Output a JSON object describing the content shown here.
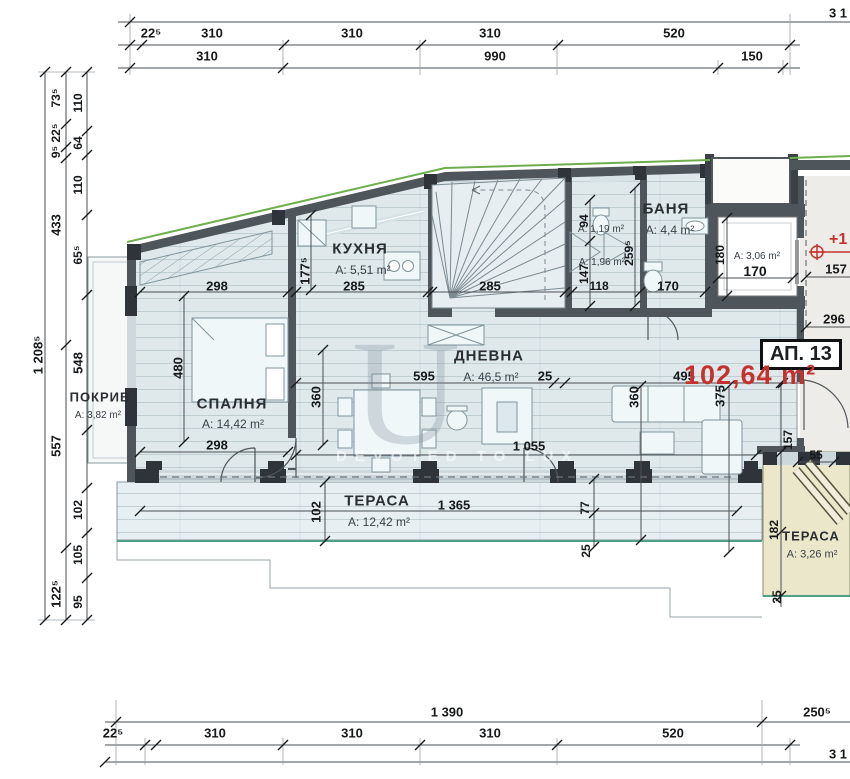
{
  "colors": {
    "red": "#c5322d",
    "green_top": "#6fae4e",
    "green_edge": "#4f9f86",
    "wall": "#4e555b",
    "pier": "#2e3439",
    "floor": "#dfe9ec",
    "terrace_beige": "#ebe7cb"
  },
  "apartment": {
    "id_label": "АП. 13",
    "area_label": "102,64 m²",
    "level_mark": "+1"
  },
  "watermark": {
    "letter": "U",
    "tagline": "DEVOTED TO LUX"
  },
  "rooms": [
    {
      "name": "ПОКРИВ",
      "area": "A: 3,82 m²",
      "nx": 100,
      "ny": 397,
      "ax": 98,
      "ay": 416,
      "ns": 13,
      "as": 10
    },
    {
      "name": "СПАЛНЯ",
      "area": "A: 14,42 m²",
      "nx": 232,
      "ny": 404,
      "ax": 233,
      "ay": 424,
      "ns": 15,
      "as": 12
    },
    {
      "name": "КУХНЯ",
      "area": "A: 5,51 m²",
      "nx": 360,
      "ny": 249,
      "ax": 363,
      "ay": 270,
      "ns": 15,
      "as": 12
    },
    {
      "name": "ДНЕВНА",
      "area": "A: 46,5 m²",
      "nx": 489,
      "ny": 356,
      "ax": 491,
      "ay": 377,
      "ns": 15,
      "as": 12
    },
    {
      "name": "БАНЯ",
      "area": "A: 4,4 m²",
      "nx": 666,
      "ny": 209,
      "ax": 670,
      "ay": 230,
      "ns": 15,
      "as": 12
    },
    {
      "name": "ТЕРАСА",
      "area": "A: 12,42 m²",
      "nx": 377,
      "ny": 501,
      "ax": 379,
      "ay": 522,
      "ns": 15,
      "as": 12
    },
    {
      "name": "ТЕРАСА",
      "area": "A: 3,26 m²",
      "nx": 811,
      "ny": 536,
      "ax": 812,
      "ay": 555,
      "ns": 13,
      "as": 11
    },
    {
      "name": "",
      "area": "A: 1,19 m²",
      "ax": 601,
      "ay": 230,
      "as": 10
    },
    {
      "name": "",
      "area": "A: 1,96 m²",
      "ax": 602,
      "ay": 263,
      "as": 10
    },
    {
      "name": "",
      "area": "A: 3,06 m²",
      "ax": 757,
      "ay": 257,
      "as": 10
    }
  ],
  "dims": [
    {
      "t": "3 1",
      "x": 838,
      "y": 13
    },
    {
      "t": "22⁵",
      "x": 151,
      "y": 33
    },
    {
      "t": "310",
      "x": 212,
      "y": 33
    },
    {
      "t": "310",
      "x": 352,
      "y": 33
    },
    {
      "t": "310",
      "x": 490,
      "y": 33
    },
    {
      "t": "520",
      "x": 674,
      "y": 33
    },
    {
      "t": "310",
      "x": 207,
      "y": 56
    },
    {
      "t": "990",
      "x": 495,
      "y": 56
    },
    {
      "t": "150",
      "x": 752,
      "y": 56
    },
    {
      "t": "1 390",
      "x": 447,
      "y": 712
    },
    {
      "t": "250⁵",
      "x": 817,
      "y": 712
    },
    {
      "t": "22⁵",
      "x": 113,
      "y": 733
    },
    {
      "t": "310",
      "x": 215,
      "y": 733
    },
    {
      "t": "310",
      "x": 352,
      "y": 733
    },
    {
      "t": "310",
      "x": 490,
      "y": 733
    },
    {
      "t": "520",
      "x": 673,
      "y": 733
    },
    {
      "t": "3 1",
      "x": 838,
      "y": 754
    },
    {
      "t": "1 208⁵",
      "x": 38,
      "y": 355,
      "o": "v"
    },
    {
      "t": "73⁵",
      "x": 56,
      "y": 98,
      "o": "v",
      "s": 12
    },
    {
      "t": "22⁵",
      "x": 56,
      "y": 133,
      "o": "v",
      "s": 12
    },
    {
      "t": "9⁵",
      "x": 56,
      "y": 152,
      "o": "v",
      "s": 12
    },
    {
      "t": "433",
      "x": 56,
      "y": 225,
      "o": "v"
    },
    {
      "t": "557",
      "x": 56,
      "y": 446,
      "o": "v"
    },
    {
      "t": "122⁵",
      "x": 56,
      "y": 594,
      "o": "v"
    },
    {
      "t": "110",
      "x": 78,
      "y": 103,
      "o": "v",
      "s": 12
    },
    {
      "t": "64",
      "x": 78,
      "y": 143,
      "o": "v",
      "s": 12
    },
    {
      "t": "110",
      "x": 78,
      "y": 185,
      "o": "v",
      "s": 12
    },
    {
      "t": "65⁵",
      "x": 78,
      "y": 255,
      "o": "v",
      "s": 12
    },
    {
      "t": "548",
      "x": 78,
      "y": 363,
      "o": "v"
    },
    {
      "t": "102",
      "x": 78,
      "y": 510,
      "o": "v",
      "s": 12
    },
    {
      "t": "105",
      "x": 78,
      "y": 555,
      "o": "v",
      "s": 12
    },
    {
      "t": "95",
      "x": 78,
      "y": 602,
      "o": "v",
      "s": 12
    },
    {
      "t": "298",
      "x": 217,
      "y": 286
    },
    {
      "t": "480",
      "x": 178,
      "y": 368,
      "o": "v"
    },
    {
      "t": "298",
      "x": 217,
      "y": 445
    },
    {
      "t": "360",
      "x": 316,
      "y": 397,
      "o": "v"
    },
    {
      "t": "177⁵",
      "x": 305,
      "y": 271,
      "o": "v"
    },
    {
      "t": "285",
      "x": 354,
      "y": 286
    },
    {
      "t": "285",
      "x": 490,
      "y": 286
    },
    {
      "t": "94",
      "x": 584,
      "y": 221,
      "o": "v",
      "s": 12
    },
    {
      "t": "147",
      "x": 584,
      "y": 274,
      "o": "v",
      "s": 12
    },
    {
      "t": "118",
      "x": 599,
      "y": 286,
      "s": 12
    },
    {
      "t": "259⁵",
      "x": 629,
      "y": 253,
      "o": "v",
      "s": 12
    },
    {
      "t": "170",
      "x": 668,
      "y": 286
    },
    {
      "t": "180",
      "x": 720,
      "y": 255,
      "o": "v",
      "s": 12
    },
    {
      "t": "170",
      "x": 755,
      "y": 271,
      "s": 14
    },
    {
      "t": "595",
      "x": 424,
      "y": 376
    },
    {
      "t": "25",
      "x": 545,
      "y": 376
    },
    {
      "t": "495",
      "x": 684,
      "y": 376
    },
    {
      "t": "360",
      "x": 634,
      "y": 397,
      "o": "v"
    },
    {
      "t": "375",
      "x": 720,
      "y": 396,
      "o": "v"
    },
    {
      "t": "1 055",
      "x": 529,
      "y": 446
    },
    {
      "t": "1 365",
      "x": 454,
      "y": 505
    },
    {
      "t": "102",
      "x": 316,
      "y": 512,
      "o": "v"
    },
    {
      "t": "77",
      "x": 585,
      "y": 508,
      "o": "v",
      "s": 12
    },
    {
      "t": "25",
      "x": 586,
      "y": 551,
      "o": "v",
      "s": 12
    },
    {
      "t": "157",
      "x": 836,
      "y": 269
    },
    {
      "t": "296",
      "x": 834,
      "y": 319
    },
    {
      "t": "157",
      "x": 788,
      "y": 440,
      "o": "v",
      "s": 12
    },
    {
      "t": "55",
      "x": 816,
      "y": 455,
      "s": 12
    },
    {
      "t": "182",
      "x": 774,
      "y": 530,
      "o": "v",
      "s": 12
    },
    {
      "t": "25",
      "x": 777,
      "y": 597,
      "o": "v",
      "s": 12
    }
  ]
}
